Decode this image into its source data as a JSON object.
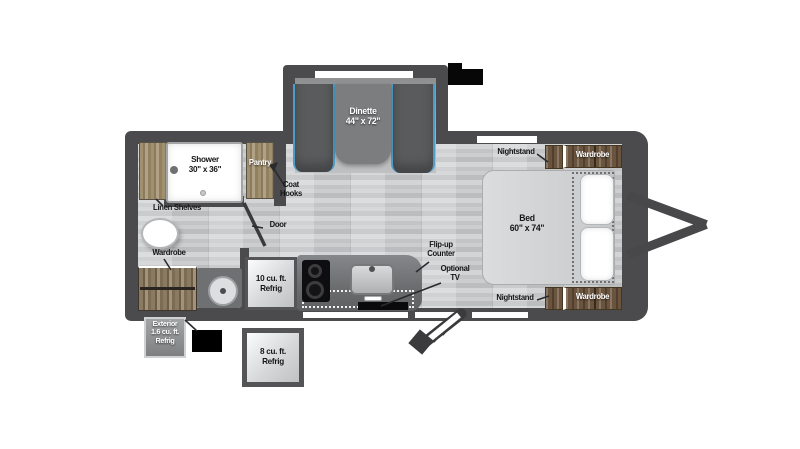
{
  "meta": {
    "view": "travel-trailer-floorplan",
    "colors": {
      "wall": "#4b4b4d",
      "floor": "#c6c8ca",
      "accent_blue": "#4e9dc8",
      "wood": "#9c8b6e",
      "dark_wood": "#6b543d",
      "background": "#ffffff"
    }
  },
  "labels": {
    "dinette": {
      "name": "Dinette",
      "size": "44\" x 72\""
    },
    "shower": {
      "name": "Shower",
      "size": "30\" x 36\""
    },
    "pantry": "Pantry",
    "coat_hooks": {
      "line1": "Coat",
      "line2": "Hooks"
    },
    "linen_shelves": "Linen Shelves",
    "door": "Door",
    "wardrobe_left": "Wardrobe",
    "bed": {
      "name": "Bed",
      "size": "60\" x 74\""
    },
    "nightstand_top": "Nightstand",
    "nightstand_bottom": "Nightstand",
    "wardrobe_top": "Wardrobe",
    "wardrobe_bottom": "Wardrobe",
    "refrig_10": {
      "line1": "10 cu. ft.",
      "line2": "Refrig"
    },
    "refrig_8": {
      "line1": "8 cu. ft.",
      "line2": "Refrig"
    },
    "exterior_refrig": {
      "line1": "Exterior",
      "line2": "1.6 cu. ft.",
      "line3": "Refrig"
    },
    "flip_up_counter": {
      "line1": "Flip-up",
      "line2": "Counter"
    },
    "optional_tv": {
      "line1": "Optional",
      "line2": "TV"
    }
  }
}
